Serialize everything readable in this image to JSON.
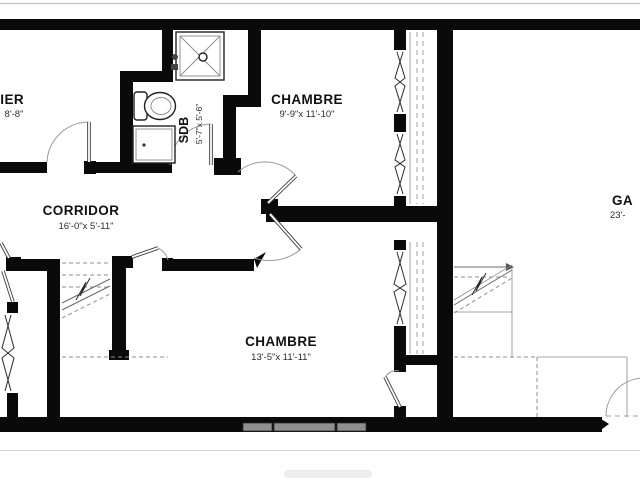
{
  "plan": {
    "type": "residential-floor-plan",
    "language": "French"
  },
  "rooms": {
    "bedroom_top": {
      "name": "CHAMBRE",
      "dims": "9'-9\"x 11'-10\""
    },
    "bathroom": {
      "name": "SDB",
      "dims": "5'-7\"x 5'-6\""
    },
    "corridor": {
      "name": "CORRIDOR",
      "dims": "16'-0\"x 5'-11\""
    },
    "bedroom_bottom": {
      "name": "CHAMBRE",
      "dims": "13'-5\"x 11'-11\""
    },
    "stairs_partial": {
      "name": "LIER",
      "dims": "8'-8\""
    },
    "garage_partial": {
      "name": "GA",
      "dims": "23'-"
    }
  },
  "colors": {
    "wall": "#0a0a0a",
    "window_fill": "#8f8f8f",
    "background": "#ffffff",
    "frame_line": "#c6c6c6"
  }
}
